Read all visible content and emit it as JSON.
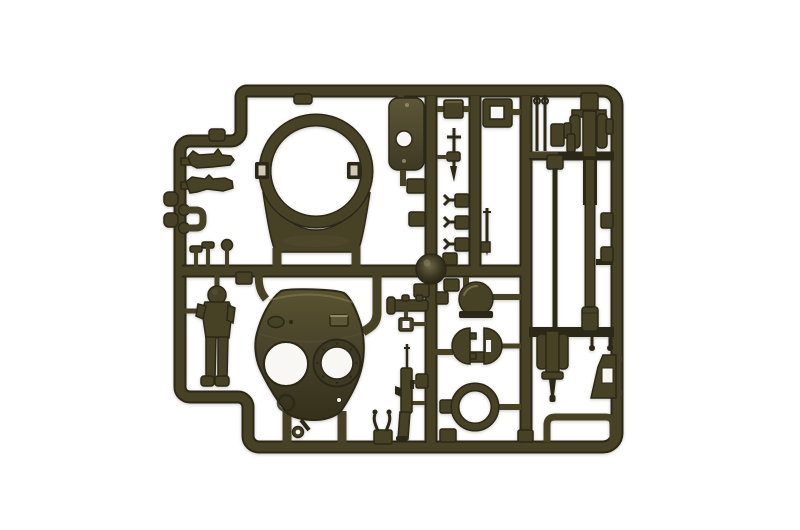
{
  "scene": {
    "description": "Olive-drab injection-molded plastic model kit sprue holding tank turret parts (turret shell with two hatch openings, turret ring, crew figure, gun barrels, hatches and small fittings) photographed on a white background"
  },
  "colors": {
    "background": "#ffffff",
    "vignette": "#efeeea",
    "plastic": "#3e3923",
    "plastic_dark": "#2b2817",
    "plastic_mid": "#474126",
    "plastic_light": "#5d5637",
    "highlight": "#9a9267",
    "hole": "#f8f7f3",
    "slot_bright": "#cfc9b6",
    "turret_top": "#59532f",
    "turret_mid": "#46412a",
    "turret_bottom": "#343019",
    "boss_light": "#6e6744",
    "boss_dark": "#23200f"
  },
  "parts": [
    {
      "label": "sprue frame"
    },
    {
      "label": "turret ring"
    },
    {
      "label": "turret shell"
    },
    {
      "label": "crew figure"
    },
    {
      "label": "hatch plate"
    },
    {
      "label": "hatch frame"
    },
    {
      "label": "dome hatch"
    },
    {
      "label": "hatch doors"
    },
    {
      "label": "seal ring"
    },
    {
      "label": "rifle"
    },
    {
      "label": "periscope"
    },
    {
      "label": "stowage tools"
    },
    {
      "label": "gun mount"
    },
    {
      "label": "gun barrel"
    },
    {
      "label": "barrel rod"
    },
    {
      "label": "breech gun"
    },
    {
      "label": "gun shield"
    },
    {
      "label": "tow bar"
    }
  ]
}
